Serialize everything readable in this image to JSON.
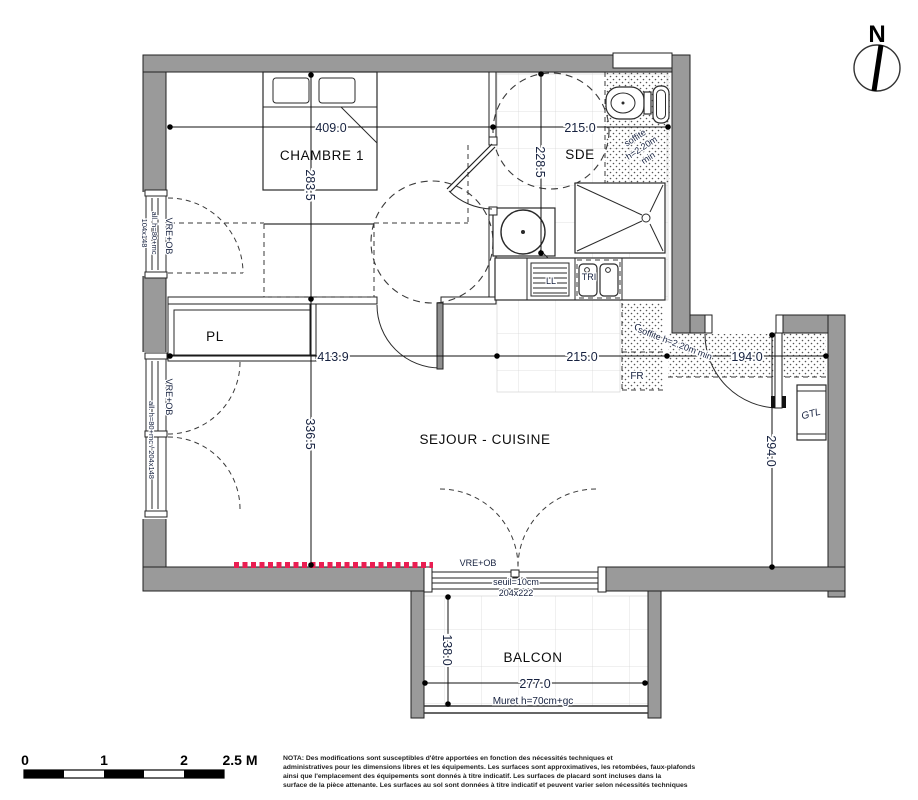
{
  "north": "N",
  "rooms": {
    "chambre": "CHAMBRE 1",
    "sde": "SDE",
    "sejour": "SEJOUR - CUISINE",
    "balcon": "BALCON",
    "pl": "PL"
  },
  "dimensions": {
    "chambre_w": "409.0",
    "chambre_h": "283.5",
    "sde_w": "215.0",
    "sde_h": "228.5",
    "sejour_w": "413.9",
    "kitchen_w": "215.0",
    "entry_w": "194.0",
    "sejour_h": "336.5",
    "entry_h": "294.0",
    "balcon_w": "277.0",
    "balcon_h": "138.0"
  },
  "annotations": {
    "soffite_sde": [
      "soffite",
      "h=2.20m",
      "min"
    ],
    "soffite_entry": "soffite h=2.20m min",
    "window1_vre": "VRE+OB",
    "window1_allege": "all. h=80+mc",
    "window1_size": "104x148",
    "window2_vre": "VRE+OB",
    "window2_allege": "all. h=80+mc / 204x148",
    "balcony_door_vre": "VRE+OB",
    "seuil": "seuil=10cm",
    "balcony_door_size": "204x222",
    "muret": "Muret h=70cm+gc"
  },
  "appliances": {
    "ll": "LL",
    "tri": "TRI",
    "c": "C",
    "fr": "FR",
    "gtl": "GTL"
  },
  "scalebar": {
    "t0": "0",
    "t1": "1",
    "t2": "2",
    "t25": "2.5 M"
  },
  "nota": {
    "l1": "NOTA: Des modifications sont susceptibles d'être apportées en fonction des nécessités techniques et",
    "l2": "administratives pour les dimensions libres et les équipements. Les surfaces sont approximatives, les retombées, faux-plafonds",
    "l3": "ainsi que l'emplacement des équipements sont donnés à titre indicatif. Les surfaces de placard sont incluses dans la",
    "l4": "surface de la pièce attenante. Les surfaces au sol sont données à titre indicatif et peuvent varier selon nécessités techniques"
  },
  "colors": {
    "wall": "#9a9a9a",
    "accent_red": "#ea1e52",
    "annotation": "#16213f"
  }
}
